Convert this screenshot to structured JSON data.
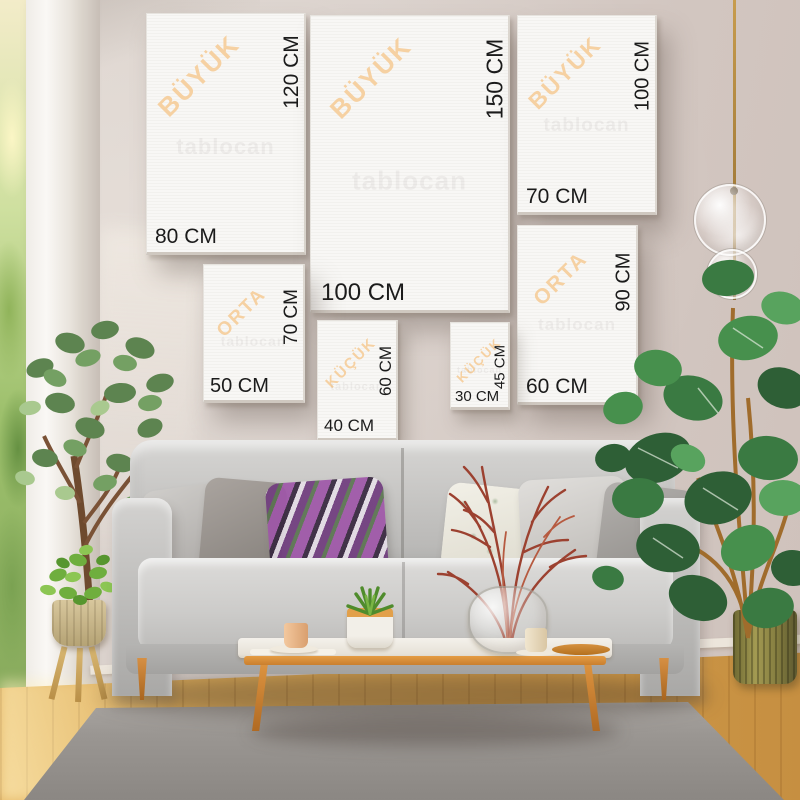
{
  "meta": {
    "description": "Canvas wall-art size guide mockup over living-room photo",
    "language": "Turkish"
  },
  "scene": {
    "watermark": "tablocan",
    "panels": [
      {
        "id": "buyuk-80x120",
        "category": "BÜYÜK",
        "height_label": "120 CM",
        "width_label": "80 CM"
      },
      {
        "id": "buyuk-100x150",
        "category": "BÜYÜK",
        "height_label": "150 CM",
        "width_label": "100 CM"
      },
      {
        "id": "buyuk-70x100",
        "category": "BÜYÜK",
        "height_label": "100 CM",
        "width_label": "70 CM"
      },
      {
        "id": "orta-60x90",
        "category": "ORTA",
        "height_label": "90 CM",
        "width_label": "60 CM"
      },
      {
        "id": "orta-50x70",
        "category": "ORTA",
        "height_label": "70 CM",
        "width_label": "50 CM"
      },
      {
        "id": "kucuk-40x60",
        "category": "KÜÇÜK",
        "height_label": "60 CM",
        "width_label": "40 CM"
      },
      {
        "id": "kucuk-30x45",
        "category": "KÜÇÜK",
        "height_label": "45 CM",
        "width_label": "30 CM"
      }
    ],
    "colors": {
      "category_label": "#f6cf9e",
      "dimension_label": "#1b1b1b",
      "wall": "#d7cfca",
      "floor_wood": "#d5a152",
      "sofa": "#c2c1bf",
      "table_wood": "#dd9440",
      "branch_accent": "#9c4130",
      "plant_green": "#3a7a42"
    }
  }
}
